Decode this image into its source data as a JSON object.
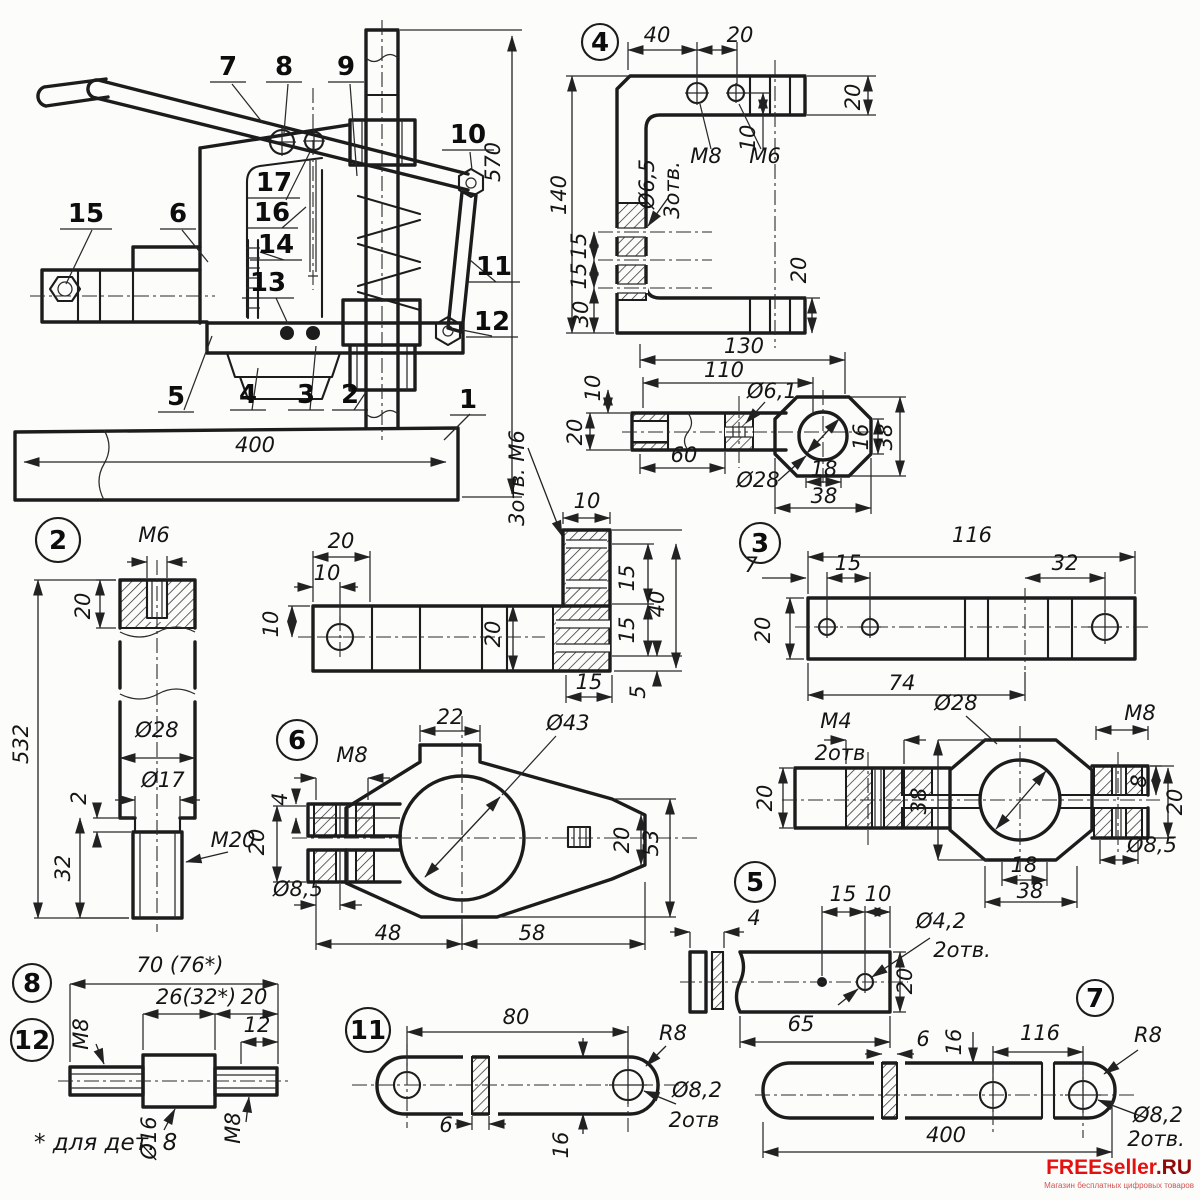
{
  "watermark": {
    "brand": "FREEseller",
    "suffix": ".RU",
    "tagline": "Магазин бесплатных цифровых товаров"
  },
  "part_circles": [
    {
      "n": "4",
      "x": 600,
      "y": 42,
      "r": 18
    },
    {
      "n": "2",
      "x": 58,
      "y": 540,
      "r": 22
    },
    {
      "n": "3",
      "x": 760,
      "y": 543,
      "r": 20
    },
    {
      "n": "6",
      "x": 297,
      "y": 740,
      "r": 20
    },
    {
      "n": "5",
      "x": 755,
      "y": 882,
      "r": 20
    },
    {
      "n": "8",
      "x": 32,
      "y": 983,
      "r": 19
    },
    {
      "n": "12",
      "x": 32,
      "y": 1040,
      "r": 21
    },
    {
      "n": "11",
      "x": 368,
      "y": 1030,
      "r": 22
    },
    {
      "n": "7",
      "x": 1095,
      "y": 998,
      "r": 18
    }
  ],
  "assembly_callouts": [
    {
      "n": "7",
      "x": 228,
      "y": 75
    },
    {
      "n": "8",
      "x": 284,
      "y": 75
    },
    {
      "n": "9",
      "x": 346,
      "y": 75
    },
    {
      "n": "10",
      "x": 468,
      "y": 143
    },
    {
      "n": "15",
      "x": 86,
      "y": 222
    },
    {
      "n": "6",
      "x": 178,
      "y": 222
    },
    {
      "n": "17",
      "x": 274,
      "y": 191
    },
    {
      "n": "16",
      "x": 272,
      "y": 221
    },
    {
      "n": "14",
      "x": 276,
      "y": 253
    },
    {
      "n": "13",
      "x": 268,
      "y": 291
    },
    {
      "n": "11",
      "x": 494,
      "y": 275
    },
    {
      "n": "12",
      "x": 492,
      "y": 330
    },
    {
      "n": "5",
      "x": 176,
      "y": 405
    },
    {
      "n": "4",
      "x": 248,
      "y": 403
    },
    {
      "n": "3",
      "x": 306,
      "y": 403
    },
    {
      "n": "2",
      "x": 350,
      "y": 403
    },
    {
      "n": "1",
      "x": 468,
      "y": 408
    }
  ],
  "labels": {
    "assembly": [
      {
        "t": "400",
        "x": 255,
        "y": 452
      },
      {
        "t": "570",
        "x": 500,
        "y": 162,
        "r": -90
      },
      {
        "t": "3отв. М6",
        "x": 524,
        "y": 478,
        "r": -90
      }
    ],
    "part4": [
      {
        "t": "40",
        "x": 657,
        "y": 42
      },
      {
        "t": "20",
        "x": 740,
        "y": 42
      },
      {
        "t": "М8",
        "x": 706,
        "y": 163
      },
      {
        "t": "М6",
        "x": 765,
        "y": 163
      },
      {
        "t": "Ø6,5",
        "x": 654,
        "y": 184,
        "r": -90
      },
      {
        "t": "3отв.",
        "x": 679,
        "y": 190,
        "r": -90
      },
      {
        "t": "140",
        "x": 566,
        "y": 195,
        "r": -90
      },
      {
        "t": "15",
        "x": 586,
        "y": 246,
        "r": -90
      },
      {
        "t": "15",
        "x": 586,
        "y": 276,
        "r": -90
      },
      {
        "t": "30",
        "x": 588,
        "y": 314,
        "r": -90
      },
      {
        "t": "10",
        "x": 755,
        "y": 138,
        "r": -90
      },
      {
        "t": "20",
        "x": 860,
        "y": 97,
        "r": -90
      },
      {
        "t": "20",
        "x": 806,
        "y": 270,
        "r": -90
      },
      {
        "t": "130",
        "x": 744,
        "y": 353
      }
    ],
    "rod4": [
      {
        "t": "110",
        "x": 724,
        "y": 377
      },
      {
        "t": "Ø6,1",
        "x": 772,
        "y": 398
      },
      {
        "t": "60",
        "x": 684,
        "y": 462
      },
      {
        "t": "Ø28",
        "x": 758,
        "y": 487
      },
      {
        "t": "10",
        "x": 600,
        "y": 388,
        "r": -90
      },
      {
        "t": "20",
        "x": 582,
        "y": 432,
        "r": -90
      },
      {
        "t": "16",
        "x": 868,
        "y": 437,
        "r": -90
      },
      {
        "t": "38",
        "x": 892,
        "y": 437,
        "r": -90
      },
      {
        "t": "18",
        "x": 824,
        "y": 476
      },
      {
        "t": "38",
        "x": 824,
        "y": 503
      }
    ],
    "part2": [
      {
        "t": "М6",
        "x": 154,
        "y": 542
      },
      {
        "t": "20",
        "x": 90,
        "y": 606,
        "r": -90
      },
      {
        "t": "532",
        "x": 28,
        "y": 744,
        "r": -90
      },
      {
        "t": "Ø28",
        "x": 157,
        "y": 737
      },
      {
        "t": "Ø17",
        "x": 163,
        "y": 787
      },
      {
        "t": "2",
        "x": 86,
        "y": 798,
        "r": -90
      },
      {
        "t": "32",
        "x": 70,
        "y": 868,
        "r": -90
      },
      {
        "t": "М20",
        "x": 233,
        "y": 847
      }
    ],
    "lbracket": [
      {
        "t": "20",
        "x": 341,
        "y": 548
      },
      {
        "t": "10",
        "x": 327,
        "y": 580
      },
      {
        "t": "10",
        "x": 278,
        "y": 624,
        "r": -90
      },
      {
        "t": "20",
        "x": 500,
        "y": 634,
        "r": -90
      },
      {
        "t": "10",
        "x": 587,
        "y": 508
      },
      {
        "t": "15",
        "x": 634,
        "y": 578,
        "r": -90
      },
      {
        "t": "15",
        "x": 634,
        "y": 630,
        "r": -90
      },
      {
        "t": "40",
        "x": 664,
        "y": 604,
        "r": -90
      },
      {
        "t": "15",
        "x": 589,
        "y": 689
      },
      {
        "t": "5",
        "x": 645,
        "y": 692,
        "r": -90
      }
    ],
    "part3": [
      {
        "t": "116",
        "x": 972,
        "y": 542
      },
      {
        "t": "7",
        "x": 751,
        "y": 572
      },
      {
        "t": "15",
        "x": 848,
        "y": 570
      },
      {
        "t": "32",
        "x": 1065,
        "y": 570
      },
      {
        "t": "20",
        "x": 770,
        "y": 630,
        "r": -90
      },
      {
        "t": "74",
        "x": 902,
        "y": 690
      }
    ],
    "part6": [
      {
        "t": "22",
        "x": 450,
        "y": 724
      },
      {
        "t": "Ø43",
        "x": 568,
        "y": 730
      },
      {
        "t": "М8",
        "x": 352,
        "y": 762
      },
      {
        "t": "4",
        "x": 287,
        "y": 799,
        "r": -90
      },
      {
        "t": "20",
        "x": 264,
        "y": 842,
        "r": -90
      },
      {
        "t": "Ø8,5",
        "x": 298,
        "y": 896
      },
      {
        "t": "48",
        "x": 388,
        "y": 940
      },
      {
        "t": "58",
        "x": 532,
        "y": 940
      },
      {
        "t": "20",
        "x": 629,
        "y": 840,
        "r": -90
      },
      {
        "t": "53",
        "x": 658,
        "y": 843,
        "r": -90
      }
    ],
    "m4clamp": [
      {
        "t": "М4",
        "x": 836,
        "y": 728
      },
      {
        "t": "2отв",
        "x": 840,
        "y": 760
      },
      {
        "t": "Ø28",
        "x": 956,
        "y": 710
      },
      {
        "t": "М8",
        "x": 1140,
        "y": 720
      },
      {
        "t": "8",
        "x": 1146,
        "y": 781,
        "r": -90
      },
      {
        "t": "20",
        "x": 1182,
        "y": 802,
        "r": -90
      },
      {
        "t": "Ø8,5",
        "x": 1152,
        "y": 852
      },
      {
        "t": "38",
        "x": 926,
        "y": 801,
        "r": -90
      },
      {
        "t": "18",
        "x": 1024,
        "y": 872
      },
      {
        "t": "38",
        "x": 1030,
        "y": 898
      },
      {
        "t": "20",
        "x": 772,
        "y": 798,
        "r": -90
      }
    ],
    "part5": [
      {
        "t": "4",
        "x": 754,
        "y": 925
      },
      {
        "t": "15",
        "x": 843,
        "y": 901
      },
      {
        "t": "10",
        "x": 878,
        "y": 901
      },
      {
        "t": "Ø4,2",
        "x": 941,
        "y": 928
      },
      {
        "t": "2отв.",
        "x": 962,
        "y": 957
      },
      {
        "t": "20",
        "x": 912,
        "y": 981,
        "r": -90
      },
      {
        "t": "65",
        "x": 801,
        "y": 1031
      }
    ],
    "part8": [
      {
        "t": "70 (76*)",
        "x": 180,
        "y": 972
      },
      {
        "t": "26(32*)",
        "x": 196,
        "y": 1004
      },
      {
        "t": "20",
        "x": 254,
        "y": 1004
      },
      {
        "t": "12",
        "x": 257,
        "y": 1032
      },
      {
        "t": "М8",
        "x": 88,
        "y": 1034,
        "r": -90
      },
      {
        "t": "Ø16",
        "x": 156,
        "y": 1138,
        "r": -90
      },
      {
        "t": "М8",
        "x": 240,
        "y": 1128,
        "r": -90
      },
      {
        "t": "* для дет. 8",
        "x": 34,
        "y": 1150,
        "c": "fnote"
      }
    ],
    "part11": [
      {
        "t": "80",
        "x": 516,
        "y": 1024
      },
      {
        "t": "R8",
        "x": 673,
        "y": 1040
      },
      {
        "t": "6",
        "x": 446,
        "y": 1132
      },
      {
        "t": "16",
        "x": 568,
        "y": 1145,
        "r": -90
      },
      {
        "t": "Ø8,2",
        "x": 697,
        "y": 1097
      },
      {
        "t": "2отв",
        "x": 694,
        "y": 1127
      }
    ],
    "part7": [
      {
        "t": "6",
        "x": 923,
        "y": 1046
      },
      {
        "t": "16",
        "x": 961,
        "y": 1042,
        "r": -90
      },
      {
        "t": "116",
        "x": 1040,
        "y": 1040
      },
      {
        "t": "R8",
        "x": 1148,
        "y": 1042
      },
      {
        "t": "400",
        "x": 946,
        "y": 1142
      },
      {
        "t": "Ø8,2",
        "x": 1158,
        "y": 1122
      },
      {
        "t": "2отв.",
        "x": 1156,
        "y": 1146
      }
    ]
  }
}
